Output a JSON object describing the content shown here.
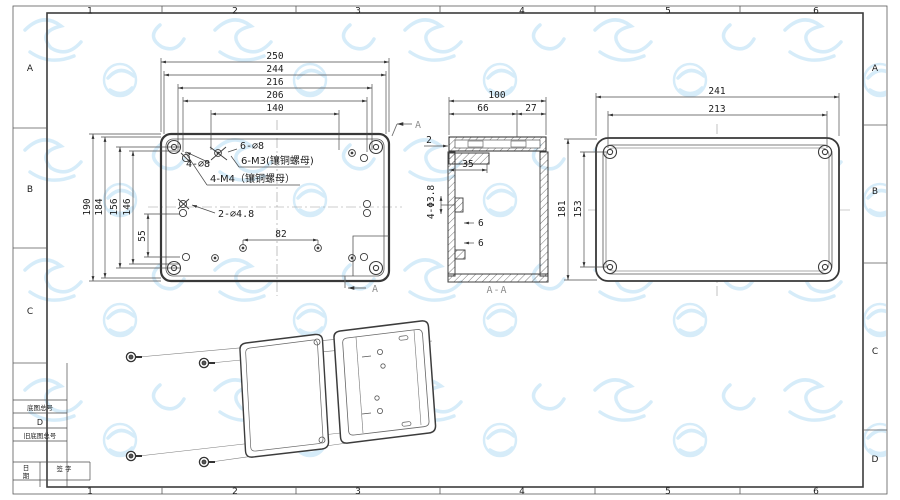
{
  "frame": {
    "cols": [
      "1",
      "2",
      "3",
      "4",
      "5",
      "6"
    ],
    "rows_left": [
      "A",
      "B",
      "C"
    ],
    "rows_right": [
      "A",
      "B",
      "C",
      "D"
    ]
  },
  "title_block": {
    "row1": "底图总号",
    "row2": "D",
    "row3": "旧底图总号",
    "date_top": "日",
    "date_bottom": "期",
    "sign": "签 字"
  },
  "front_view": {
    "dims_top": [
      "250",
      "244",
      "216",
      "206",
      "140"
    ],
    "dims_left": [
      "190",
      "184",
      "156",
      "146",
      "55"
    ],
    "dim_inner": "82",
    "label_6_d8": "6-∅8",
    "label_4_d8": "4-∅8",
    "label_6_m3": "6-M3(镶铜螺母)",
    "label_4_m4": "4-M4（镶铜螺母）",
    "label_2_d48": "2-∅4.8",
    "section_label_top": "A",
    "section_label_bottom": "A"
  },
  "section_view": {
    "dim_total": "100",
    "dim_body": "66",
    "dim_lid": "27",
    "dim_wall": "2",
    "dim_flange": "35",
    "label_holes": "4-Φ3.8",
    "dim_rib_top": "6",
    "dim_rib_bottom": "6",
    "caption": "A-A"
  },
  "rear_view": {
    "dims_top": [
      "241",
      "213"
    ],
    "dims_left": [
      "181",
      "153"
    ]
  },
  "colors": {
    "line": "#3c3c3c",
    "dim_line": "#4a4a4a",
    "caption_gray": "#8f8f8f",
    "watermark": "#cfe9f8"
  }
}
